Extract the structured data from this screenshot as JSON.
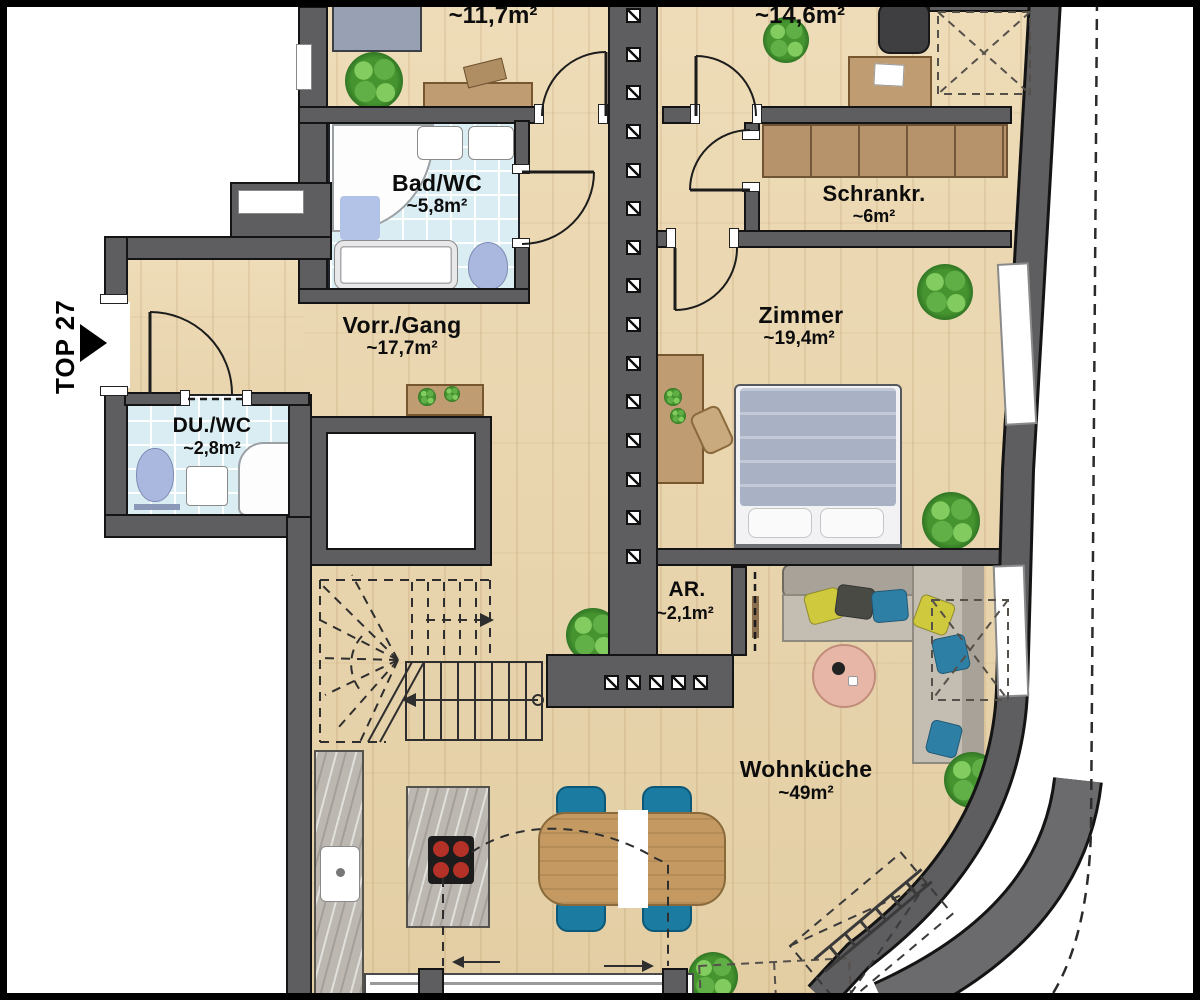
{
  "unit": {
    "label": "TOP 27"
  },
  "rooms": {
    "room_top_left": {
      "area": "~11,7m²"
    },
    "room_top_right": {
      "area": "~14,6m²"
    },
    "bad_wc": {
      "name": "Bad/WC",
      "area": "~5,8m²"
    },
    "schrankraum": {
      "name": "Schrankr.",
      "area": "~6m²"
    },
    "vorraum_gang": {
      "name": "Vorr./Gang",
      "area": "~17,7m²"
    },
    "zimmer": {
      "name": "Zimmer",
      "area": "~19,4m²"
    },
    "du_wc": {
      "name": "DU./WC",
      "area": "~2,8m²"
    },
    "abstellraum": {
      "name": "AR.",
      "area": "~2,1m²"
    },
    "wohnkueche": {
      "name": "Wohnküche",
      "area": "~49m²"
    }
  },
  "colors": {
    "wall": "#5e5e60",
    "wood": "#e9d6b0",
    "tile": "#d9edf2",
    "plant_green": "#45942f",
    "chair_blue": "#1b7ba1",
    "table_wood": "#c49a62",
    "sofa": "#c3bdb2"
  }
}
